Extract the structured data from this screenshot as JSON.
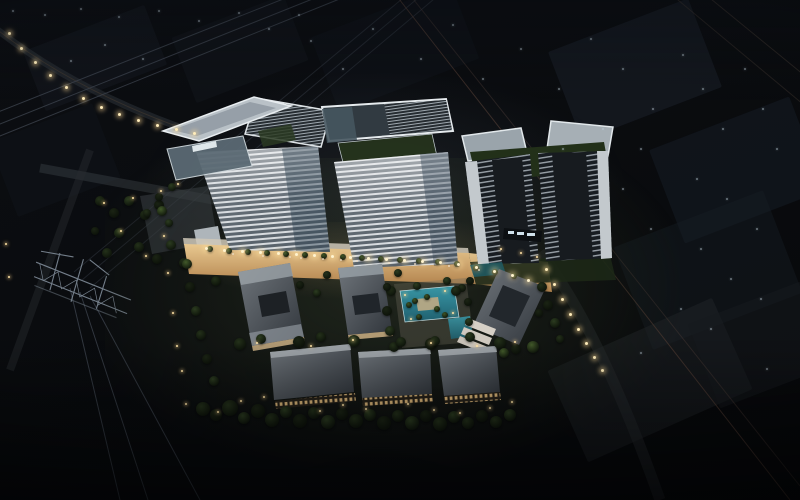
{
  "scene": {
    "alt": "Night aerial rendering of a mixed-use development: three white high-rise towers and one dark twin tower above a warm-lit retail street, five low-rise office blocks, landscaped gardens with a swimming pool and palm trees, perimeter roads with street lights, a lattice power transmission pylon with overhead lines on the left, and dark city blocks in the background"
  },
  "palette": {
    "background": "#0b0d10",
    "background_blocks": "#1a212b",
    "tower_facade_light": "#d6dade",
    "tower_facade_dark": "#57616a",
    "dark_tower_core": "#171b1f",
    "roof_deck_white": "#e6ebee",
    "roof_garden_green": "#26341d",
    "retail_street_warm": "#d8b07c",
    "pool_teal": "#2e8391",
    "tree_green": "#24311a",
    "light_warm": "#ffe3a6",
    "light_dim": "#a9bccb",
    "wire_gray": "#3c434d",
    "wire_red_tint": "#5c4338",
    "pylon_steel": "#8793a0",
    "ground_green": "#161b12"
  }
}
